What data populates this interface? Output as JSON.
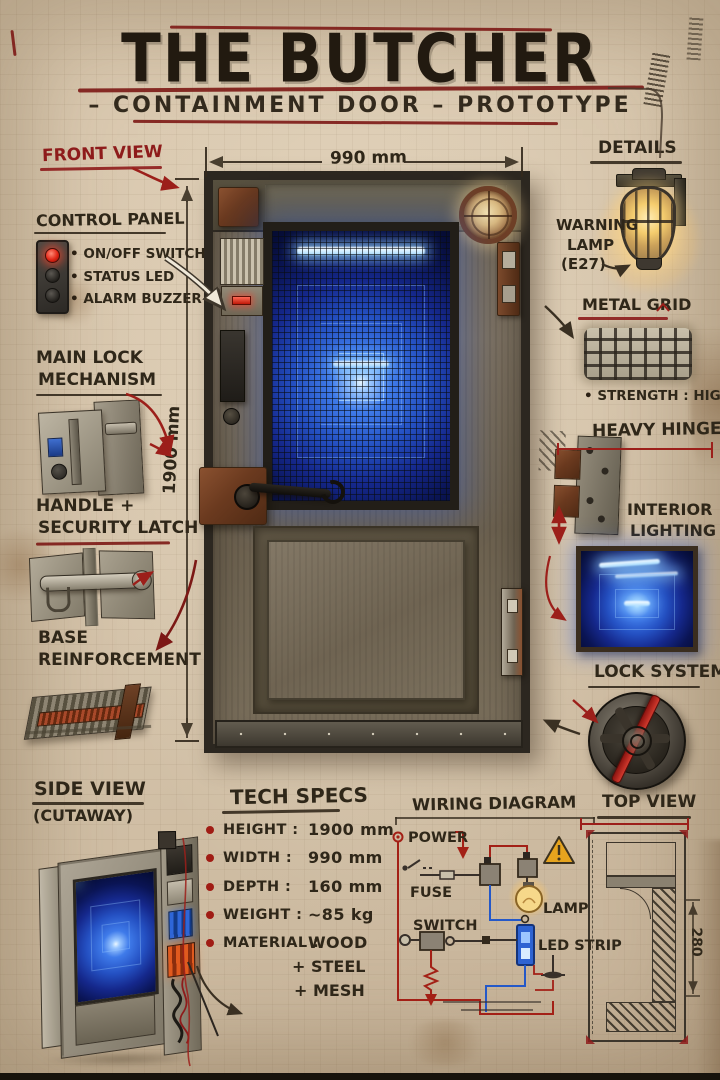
{
  "header": {
    "title": "THE BUTCHER",
    "subtitle": "– CONTAINMENT DOOR – PROTOTYPE"
  },
  "dims": {
    "door_width": "990 mm",
    "door_height": "1900 mm",
    "top_view_depth": "280"
  },
  "left": {
    "front_view": "FRONT VIEW",
    "control_panel_title": "CONTROL PANEL",
    "control_panel_items": [
      "ON/OFF SWITCH",
      "STATUS LED",
      "ALARM BUZZER"
    ],
    "main_lock_1": "MAIN LOCK",
    "main_lock_2": "MECHANISM",
    "handle_1": "HANDLE +",
    "handle_2": "SECURITY LATCH",
    "base_1": "BASE",
    "base_2": "REINFORCEMENT",
    "side_view": "SIDE VIEW",
    "side_view_sub": "(CUTAWAY)"
  },
  "right": {
    "details": "DETAILS",
    "warning_lamp_1": "WARNING",
    "warning_lamp_2": "LAMP",
    "warning_lamp_3": "(E27)",
    "metal_grid": "METAL GRID",
    "metal_grid_note": "STRENGTH :  HIGH",
    "heavy_hinges": "HEAVY HINGES",
    "interior_1": "INTERIOR",
    "interior_2": "LIGHTING",
    "lock_system": "LOCK SYSTEM",
    "top_view": "TOP VIEW"
  },
  "tech_specs": {
    "title": "TECH SPECS",
    "rows": [
      {
        "label": "HEIGHT :",
        "value": "1900 mm"
      },
      {
        "label": "WIDTH :",
        "value": "990 mm"
      },
      {
        "label": "DEPTH :",
        "value": "160 mm"
      },
      {
        "label": "WEIGHT :",
        "value": "~85 kg"
      },
      {
        "label": "MATERIAL :",
        "value": "WOOD"
      }
    ],
    "material_cont": [
      "+ STEEL",
      "+ MESH"
    ]
  },
  "wiring": {
    "title": "WIRING DIAGRAM",
    "power": "POWER",
    "fuse": "FUSE",
    "switch": "SWITCH",
    "lamp": "LAMP",
    "led_strip": "LED STRIP"
  },
  "colors": {
    "paper": "#d8c7ae",
    "ink": "#2f2719",
    "red": "#8e1b1b",
    "blue_glow": "#2457d6"
  }
}
